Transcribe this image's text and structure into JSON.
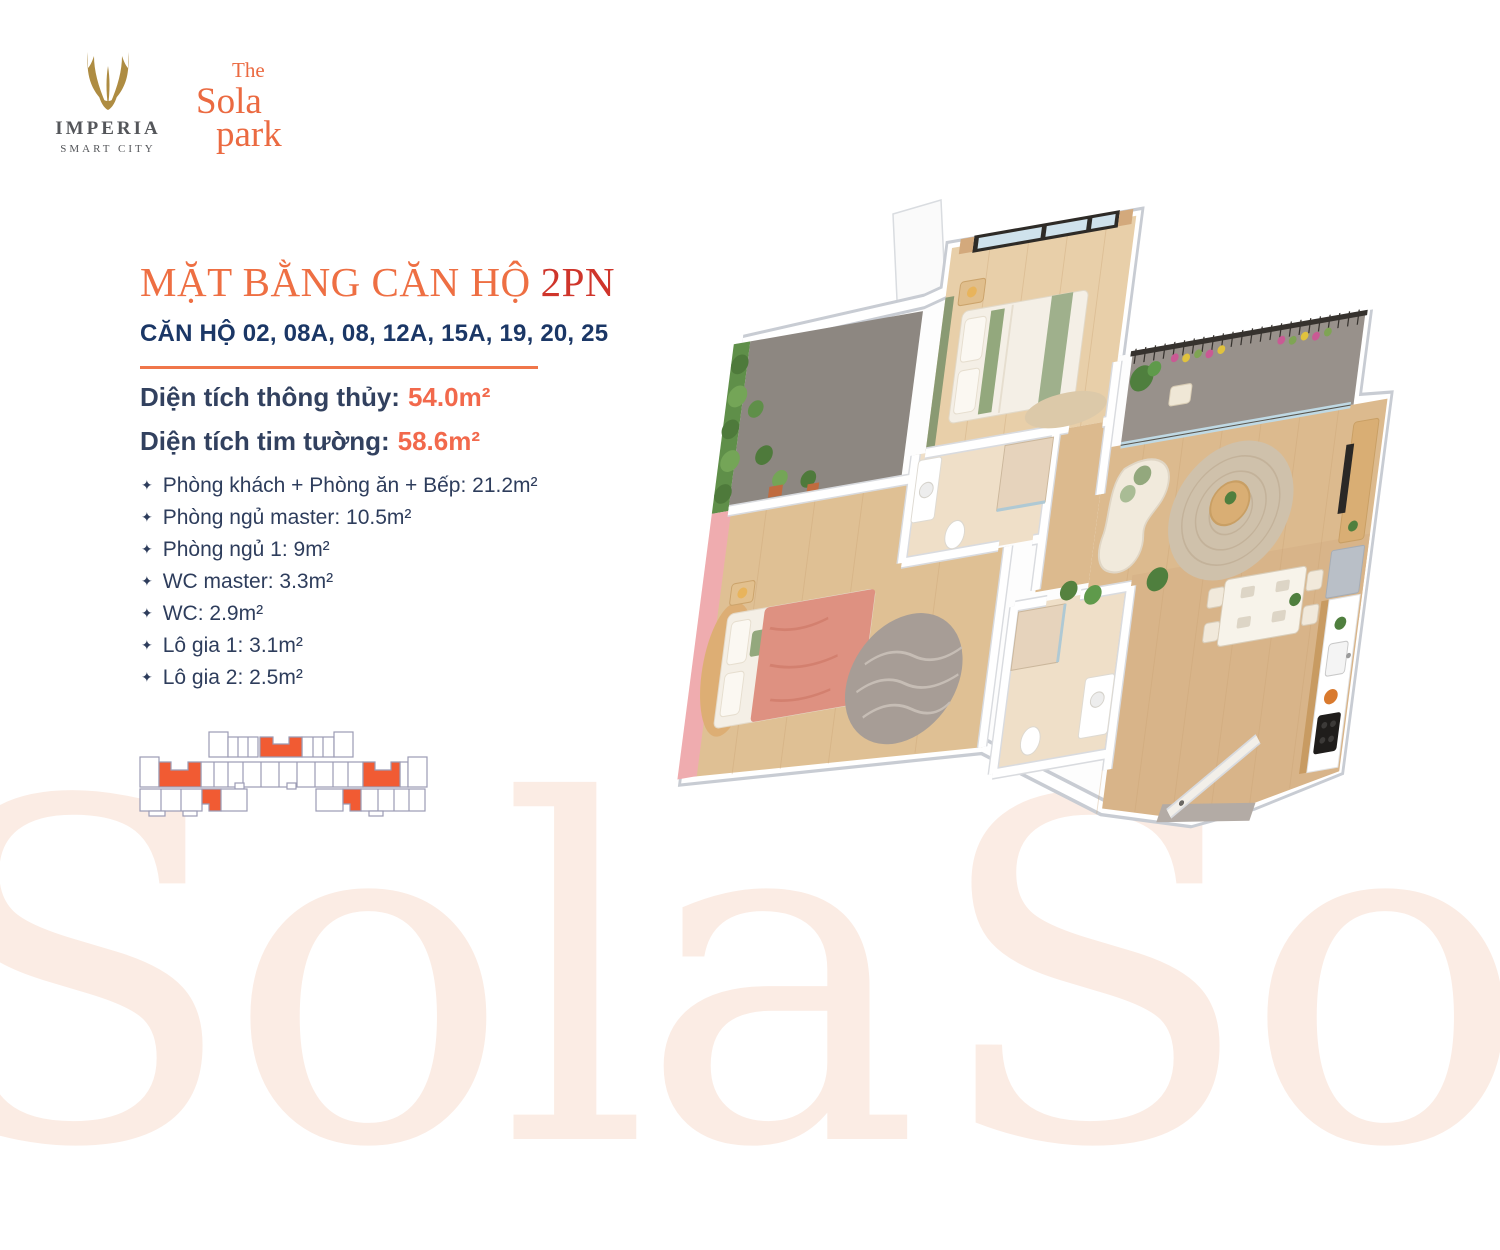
{
  "brand": {
    "imperia": {
      "name": "IMPERIA",
      "tagline": "SMART CITY"
    },
    "sola": {
      "line1": "The",
      "line2": "Sola",
      "line3": "park"
    }
  },
  "heading": {
    "title_main": "MẶT BẰNG CĂN HỘ",
    "title_suffix": "2PN",
    "subtitle": "CĂN HỘ 02, 08A, 08, 12A, 15A, 19, 20, 25"
  },
  "areas": [
    {
      "label": "Diện tích thông thủy:",
      "value": "54.0m²"
    },
    {
      "label": "Diện tích tim tường:",
      "value": "58.6m²"
    }
  ],
  "bullet_icon": "✦",
  "rooms": [
    "Phòng khách + Phòng ăn + Bếp: 21.2m²",
    "Phòng ngủ master: 10.5m²",
    "Phòng ngủ 1: 9m²",
    "WC master: 3.3m²",
    "WC: 2.9m²",
    "Lô gia 1: 3.1m²",
    "Lô gia 2: 2.5m²"
  ],
  "watermark": "Sola",
  "colors": {
    "accent_orange": "#F0764A",
    "title_red": "#CF352B",
    "navy": "#1B3766",
    "body_navy": "#2E3D5C",
    "value_orange": "#F2694C",
    "logo_gold": "#AE8C42",
    "logo_orange": "#EB6A41",
    "keyplan_outline": "#9B9BB5",
    "keyplan_highlight": "#F15B33",
    "watermark_peach": "#FBECE4",
    "plan_wood": "#DCBA8E",
    "plan_pink_wall": "#EFACAF",
    "plan_green_wall": "#5F8F49"
  }
}
